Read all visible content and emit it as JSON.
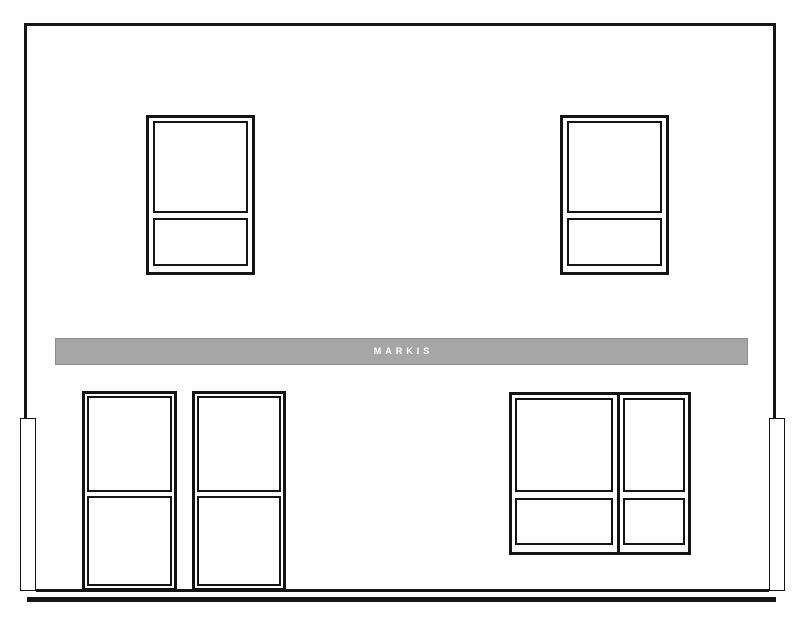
{
  "drawing": {
    "awning_label": "MARKIS"
  },
  "colors": {
    "background": "#ffffff",
    "line": "#141414",
    "awning_fill": "#a6a6a6",
    "awning_border": "#8c8c8c",
    "awning_text": "#ffffff"
  }
}
